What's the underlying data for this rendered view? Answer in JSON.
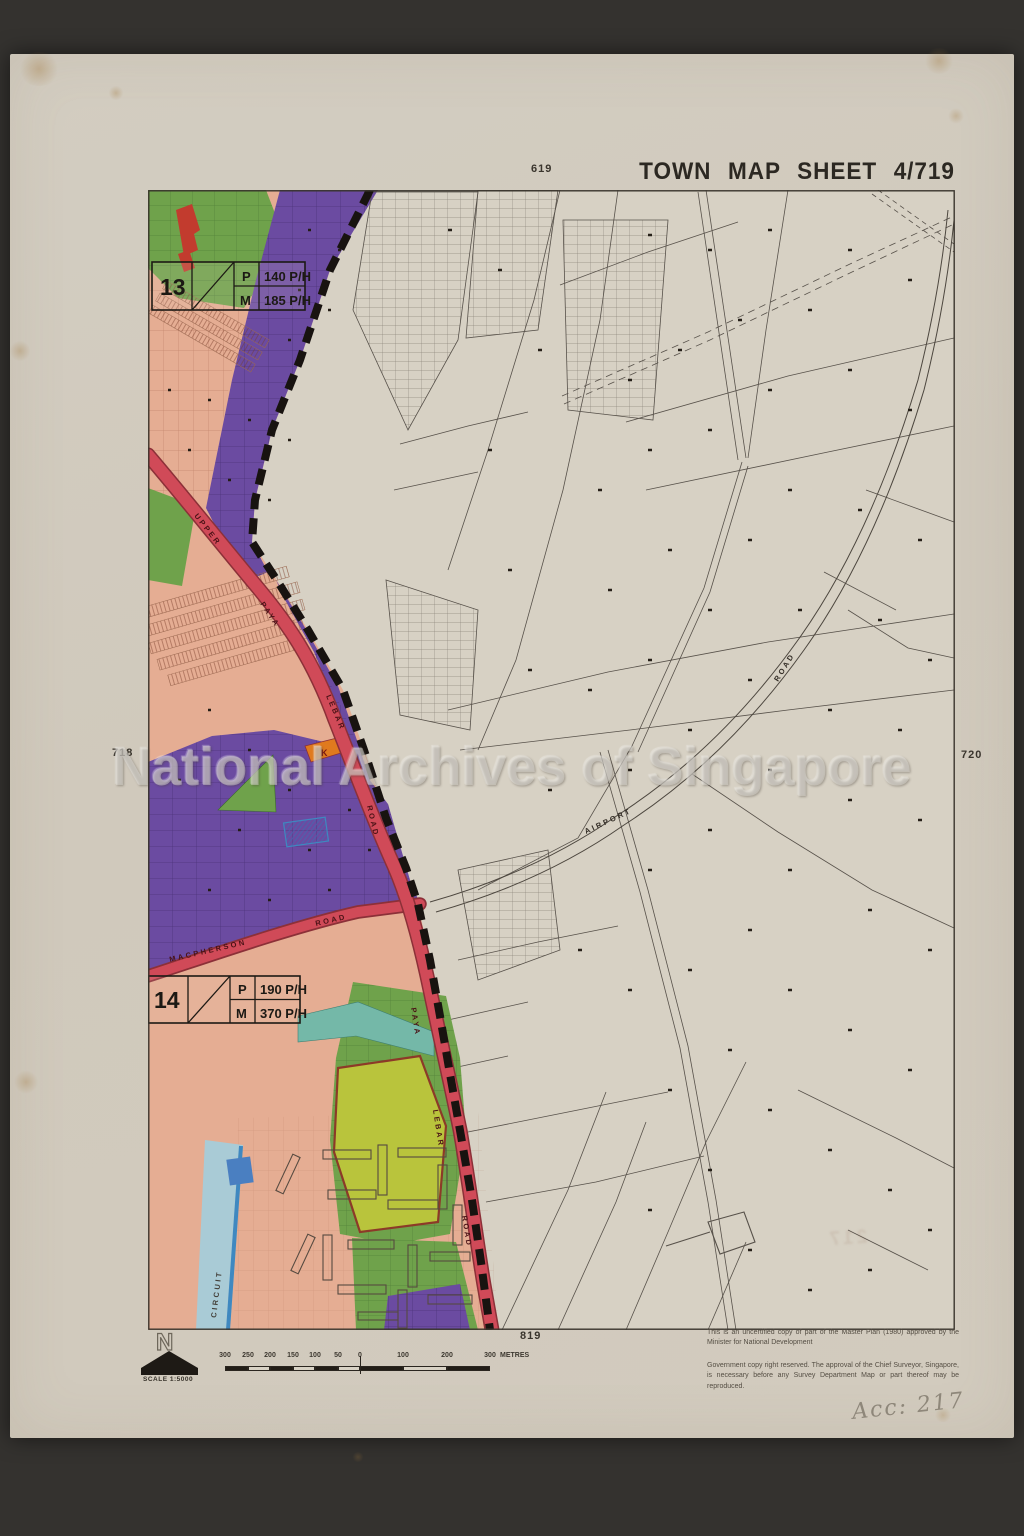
{
  "page": {
    "title": "TOWN MAP SHEET 4/719",
    "watermark": "National Archives of Singapore",
    "annotation": "Acc: 217",
    "stamp_offset": "217"
  },
  "grid_refs": {
    "top": "619",
    "left": "718",
    "right": "720",
    "bottom": "819"
  },
  "legend": {
    "block13": {
      "id": "13",
      "rows": [
        {
          "key": "P",
          "value": "140 P/H"
        },
        {
          "key": "M",
          "value": "185 P/H"
        }
      ]
    },
    "block14": {
      "id": "14",
      "rows": [
        {
          "key": "P",
          "value": "190 P/H"
        },
        {
          "key": "M",
          "value": "370 P/H"
        }
      ]
    }
  },
  "roads": {
    "upper": "UPPER",
    "paya": "PAYA",
    "lebar": "LEBAR",
    "road": "ROAD",
    "paya2": "PAYA",
    "lebar2": "LEBAR",
    "road2": "ROAD",
    "macpherson": "MACPHERSON",
    "macpherson_road": "ROAD",
    "airport": "AIRPORT",
    "airport_road": "ROAD",
    "circuit": "CIRCUIT"
  },
  "map": {
    "parcel_label": "K"
  },
  "compass": {
    "letter": "N",
    "scale_label": "SCALE 1:5000"
  },
  "scalebar": {
    "left_ticks": [
      "300",
      "250",
      "200",
      "150",
      "100",
      "50"
    ],
    "zero": "0",
    "right_ticks": [
      "100",
      "200",
      "300"
    ],
    "unit": "METRES"
  },
  "notes": {
    "line1": "This is an uncertified copy of part of the Master Plan (1980) approved by the Minister for National Development",
    "line2": "Government copy right reserved. The approval of the Chief Surveyor, Singapore, is necessary before any Survey Department Map or part thereof may be reproduced."
  },
  "colors": {
    "zone_industrial_purple": "#6b4ba1",
    "zone_residential_salmon": "#e5ad93",
    "zone_open_green": "#6fa24b",
    "zone_lime": "#b9c43c",
    "road_red": "#d04a58",
    "water_light": "#a9cbd6",
    "water_dark": "#4a7fc1",
    "parcel_orange": "#e07a1e",
    "boundary_black": "#1c1712"
  }
}
